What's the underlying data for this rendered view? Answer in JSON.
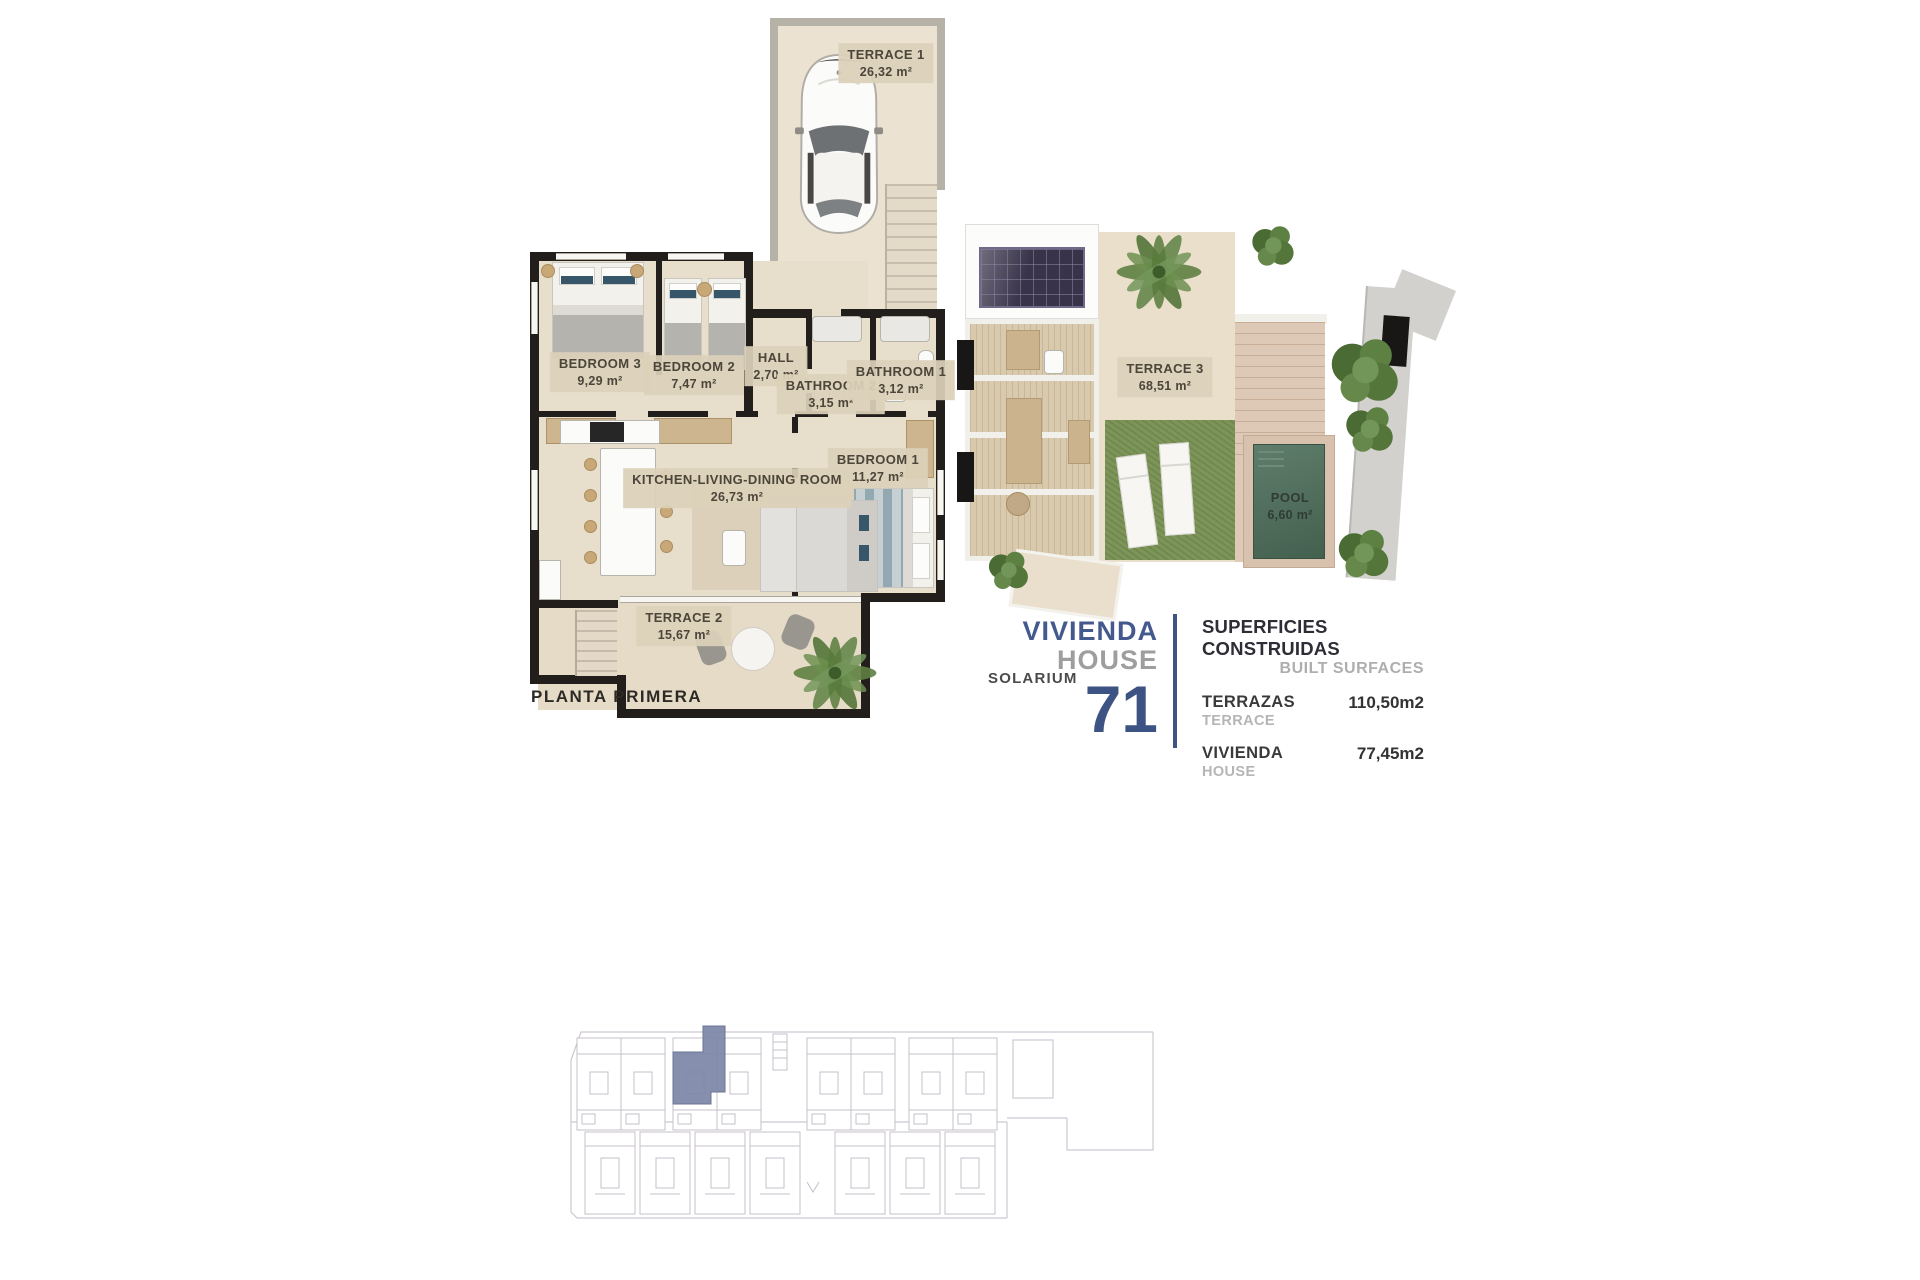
{
  "floor_plan": {
    "caption": "PLANTA PRIMERA",
    "rooms": {
      "terrace1": {
        "name": "TERRACE 1",
        "area": "26,32 m²"
      },
      "bedroom3": {
        "name": "BEDROOM 3",
        "area": "9,29 m²"
      },
      "bedroom2": {
        "name": "BEDROOM 2",
        "area": "7,47 m²"
      },
      "hall": {
        "name": "HALL",
        "area": "2,70  m²"
      },
      "bathroom2": {
        "name": "BATHROOM 2",
        "area": "3,15 m²"
      },
      "bathroom1": {
        "name": "BATHROOM 1",
        "area": "3,12 m²"
      },
      "bedroom1": {
        "name": "BEDROOM 1",
        "area": "11,27 m²"
      },
      "kitchen": {
        "name": "KITCHEN-LIVING-DINING ROOM",
        "area": "26,73 m²"
      },
      "terrace2": {
        "name": "TERRACE 2",
        "area": "15,67 m²"
      }
    }
  },
  "solarium_plan": {
    "caption": "SOLARIUM",
    "rooms": {
      "terrace3": {
        "name": "TERRACE 3",
        "area": "68,51 m²"
      },
      "pool": {
        "name": "POOL",
        "area": "6,60 m²"
      }
    }
  },
  "unit_info": {
    "title_primary": "VIVIENDA",
    "title_secondary": "HOUSE",
    "unit_number": "71",
    "surfaces_heading_primary": "SUPERFICIES CONSTRUIDAS",
    "surfaces_heading_secondary": "BUILT SURFACES",
    "surface_rows": [
      {
        "label_primary": "TERRAZAS",
        "label_secondary": "TERRACE",
        "value": "110,50m2"
      },
      {
        "label_primary": "VIVIENDA",
        "label_secondary": "HOUSE",
        "value": "77,45m2"
      }
    ]
  },
  "colors": {
    "accent_blue": "#3d5383",
    "muted_gray": "#9e9e9e",
    "wall_black": "#211e1b",
    "floor_beige": "#e8decc",
    "label_chip": "#dcd1b9",
    "grass_green": "#7d9558",
    "pool_green": "#54705f",
    "wood": "#ddc9b5",
    "site_highlight": "#7c87a7",
    "site_line": "#c9c3cf"
  }
}
